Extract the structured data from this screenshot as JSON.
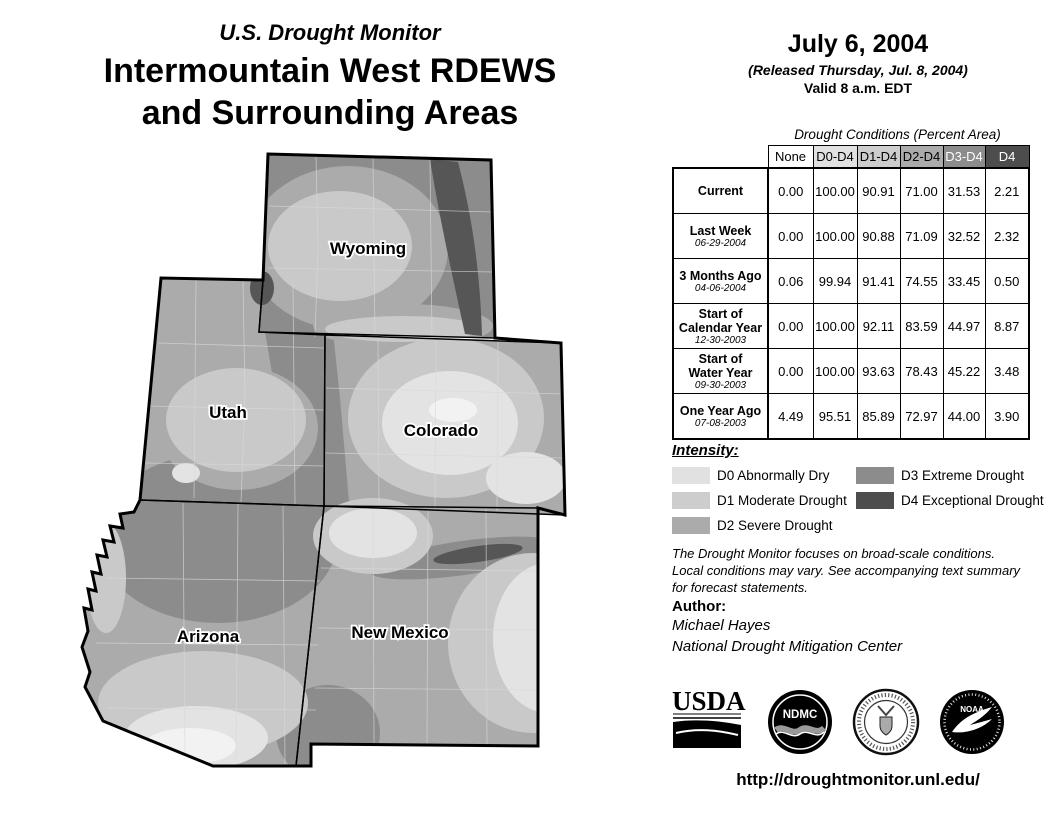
{
  "header": {
    "kicker": "U.S. Drought Monitor",
    "title_line1": "Intermountain West RDEWS",
    "title_line2": "and Surrounding Areas"
  },
  "date_block": {
    "date": "July 6, 2004",
    "released": "(Released Thursday, Jul. 8, 2004)",
    "valid": "Valid 8 a.m. EDT"
  },
  "map": {
    "state_labels": [
      "Wyoming",
      "Utah",
      "Colorado",
      "Arizona",
      "New Mexico"
    ]
  },
  "table": {
    "caption": "Drought Conditions (Percent Area)",
    "columns": [
      "None",
      "D0-D4",
      "D1-D4",
      "D2-D4",
      "D3-D4",
      "D4"
    ],
    "header_colors": [
      "#ffffff",
      "#e1e1e1",
      "#cdcdcd",
      "#ababab",
      "#8c8c8c",
      "#4d4d4d"
    ],
    "header_text_colors": [
      "#000000",
      "#000000",
      "#000000",
      "#000000",
      "#ffffff",
      "#ffffff"
    ],
    "rows": [
      {
        "label": "Current",
        "date": "",
        "values": [
          "0.00",
          "100.00",
          "90.91",
          "71.00",
          "31.53",
          "2.21"
        ]
      },
      {
        "label": "Last Week",
        "date": "06-29-2004",
        "values": [
          "0.00",
          "100.00",
          "90.88",
          "71.09",
          "32.52",
          "2.32"
        ]
      },
      {
        "label": "3 Months Ago",
        "date": "04-06-2004",
        "values": [
          "0.06",
          "99.94",
          "91.41",
          "74.55",
          "33.45",
          "0.50"
        ]
      },
      {
        "label": "Start of\nCalendar Year",
        "date": "12-30-2003",
        "values": [
          "0.00",
          "100.00",
          "92.11",
          "83.59",
          "44.97",
          "8.87"
        ]
      },
      {
        "label": "Start of\nWater Year",
        "date": "09-30-2003",
        "values": [
          "0.00",
          "100.00",
          "93.63",
          "78.43",
          "45.22",
          "3.48"
        ]
      },
      {
        "label": "One Year Ago",
        "date": "07-08-2003",
        "values": [
          "4.49",
          "95.51",
          "85.89",
          "72.97",
          "44.00",
          "3.90"
        ]
      }
    ]
  },
  "legend": {
    "title": "Intensity:",
    "items": [
      {
        "code": "D0",
        "label": "D0 Abnormally Dry",
        "color": "#e1e1e1"
      },
      {
        "code": "D1",
        "label": "D1 Moderate Drought",
        "color": "#cdcdcd"
      },
      {
        "code": "D2",
        "label": "D2 Severe Drought",
        "color": "#ababab"
      },
      {
        "code": "D3",
        "label": "D3 Extreme Drought",
        "color": "#8c8c8c"
      },
      {
        "code": "D4",
        "label": "D4 Exceptional Drought",
        "color": "#4d4d4d"
      }
    ]
  },
  "disclaimer_lines": [
    "The Drought Monitor focuses on broad-scale conditions.",
    "Local conditions may vary. See accompanying text summary",
    "for forecast statements."
  ],
  "author": {
    "heading": "Author:",
    "name": "Michael Hayes",
    "org": "National Drought Mitigation Center"
  },
  "logos": [
    "USDA",
    "NDMC",
    "Department of Commerce",
    "NOAA"
  ],
  "url": "http://droughtmonitor.unl.edu/"
}
